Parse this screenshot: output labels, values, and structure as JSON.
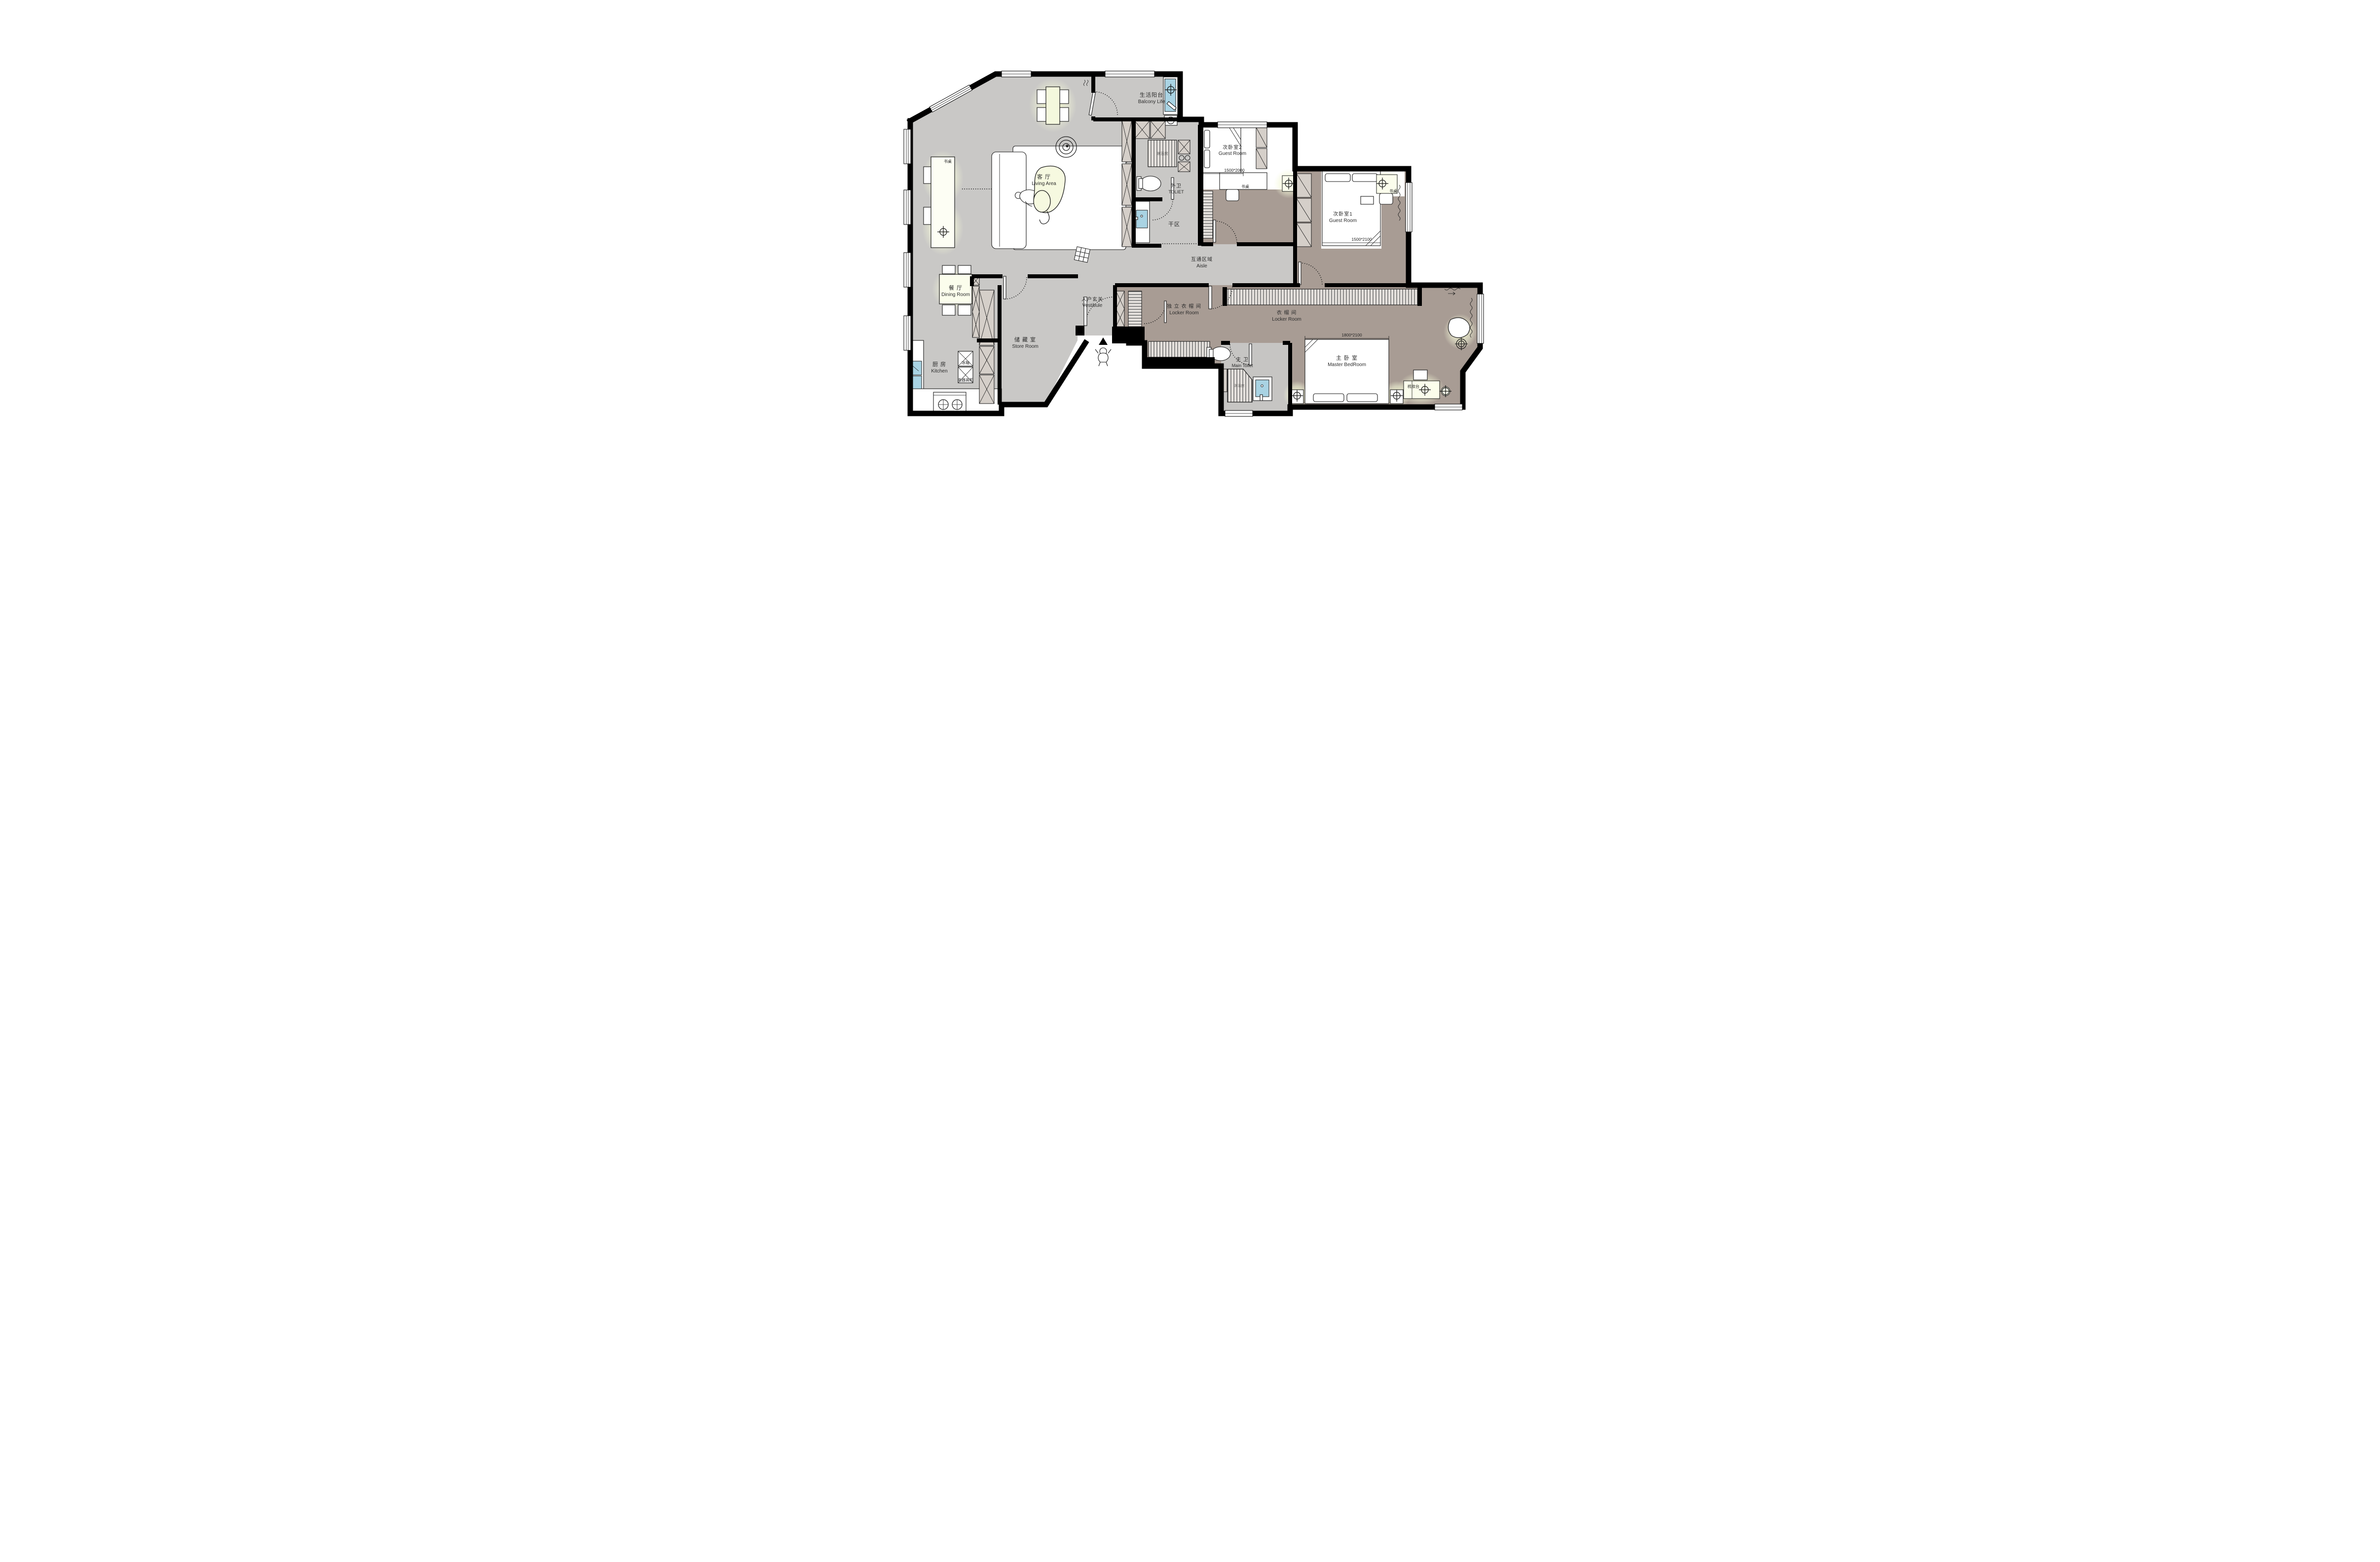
{
  "plan": {
    "rooms": {
      "balcony": {
        "zh": "生活阳台",
        "en": "Balcony Life"
      },
      "living": {
        "zh": "客  厅",
        "en": "Living Area"
      },
      "dining": {
        "zh": "餐  厅",
        "en": "Dining Room"
      },
      "kitchen": {
        "zh": "厨  房",
        "en": "Kitchen"
      },
      "store": {
        "zh": "储 藏 室",
        "en": "Store Room"
      },
      "vestibule": {
        "zh": "入户玄关",
        "en": "Vestibule"
      },
      "aisle": {
        "zh": "互通区域",
        "en": "Aisle"
      },
      "outer_toilet": {
        "zh": "外卫",
        "en": "TOLIET"
      },
      "dry_area": {
        "zh": "干区"
      },
      "guest2": {
        "zh": "次卧室2",
        "en": "Guest Room",
        "bed": "1500*2000"
      },
      "guest1": {
        "zh": "次卧室1",
        "en": "Guest Room",
        "bed": "1500*2100"
      },
      "locker_ind": {
        "zh": "独 立 衣 帽 间",
        "en": "Locker Room"
      },
      "locker": {
        "zh": "衣 帽 间",
        "en": "Locker Room"
      },
      "master": {
        "zh": "主 卧 室",
        "en": "Master BedRoom",
        "bed": "1800*2100"
      },
      "main_toilet": {
        "zh": "主 卫",
        "en": "Main Toilet"
      }
    },
    "labels": {
      "desk": "书桌",
      "fridge": "冰箱",
      "tall_cabinet": "电器高柜",
      "dresser": "梳妆台",
      "shower": "淋浴房"
    },
    "colors": {
      "wall": "#000000",
      "floor_light": "#c9c8c6",
      "floor_brown": "#a89c94",
      "cabinet": "#d5cfc9",
      "fixture_blue": "#a9d3e3",
      "glow": "#f4f8d8"
    }
  }
}
